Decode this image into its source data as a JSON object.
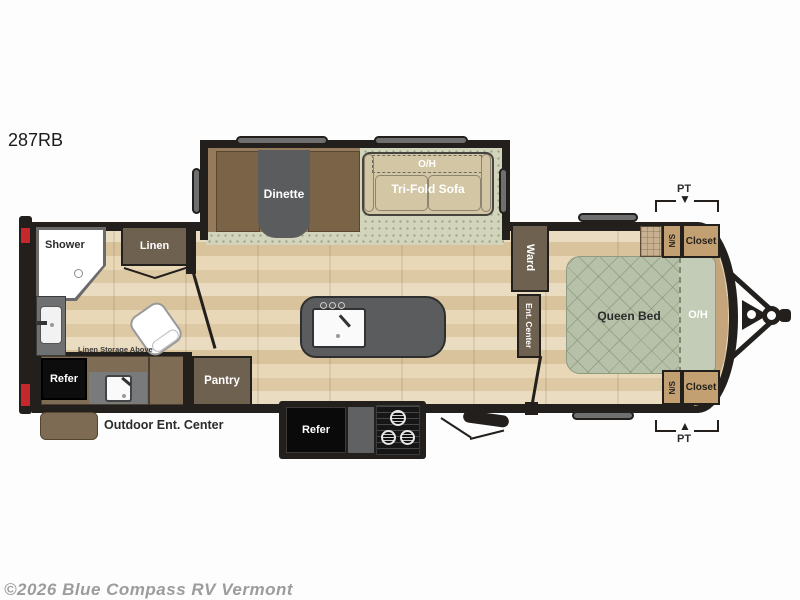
{
  "title": "287RB",
  "watermark": "©2026 Blue Compass RV Vermont",
  "slideout": {
    "oh_label": "O/H",
    "dinette_label": "Dinette",
    "sofa_label": "Tri-Fold Sofa"
  },
  "bathroom": {
    "shower_label": "Shower",
    "linen_label": "Linen",
    "storage_note": "Linen Storage Above"
  },
  "kitchen": {
    "refer_label": "Refer",
    "pantry_label": "Pantry",
    "outdoor_ent_label": "Outdoor Ent. Center"
  },
  "outdoor_kitchen": {
    "refer_label": "Refer"
  },
  "hall": {
    "ward_label": "Ward",
    "ent_center_label": "Ent. Center"
  },
  "bedroom": {
    "bed_label": "Queen Bed",
    "oh_label": "O/H",
    "closet_top_label": "Closet",
    "closet_bottom_label": "Closet",
    "ns_top_label": "N/S",
    "ns_bottom_label": "N/S",
    "pt_top_label": "PT",
    "pt_bottom_label": "PT",
    "pt_arrow_down": "▼",
    "pt_arrow_up": "▲"
  },
  "colors": {
    "wall": "#221f1c",
    "wood": "#e8d9bd",
    "carpet": "#d2d5bc",
    "cabinet_brown": "#6e6150",
    "closet_tan": "#c2a071",
    "bed_sage": "#b7c1a9",
    "marker_red": "#c4272c"
  }
}
